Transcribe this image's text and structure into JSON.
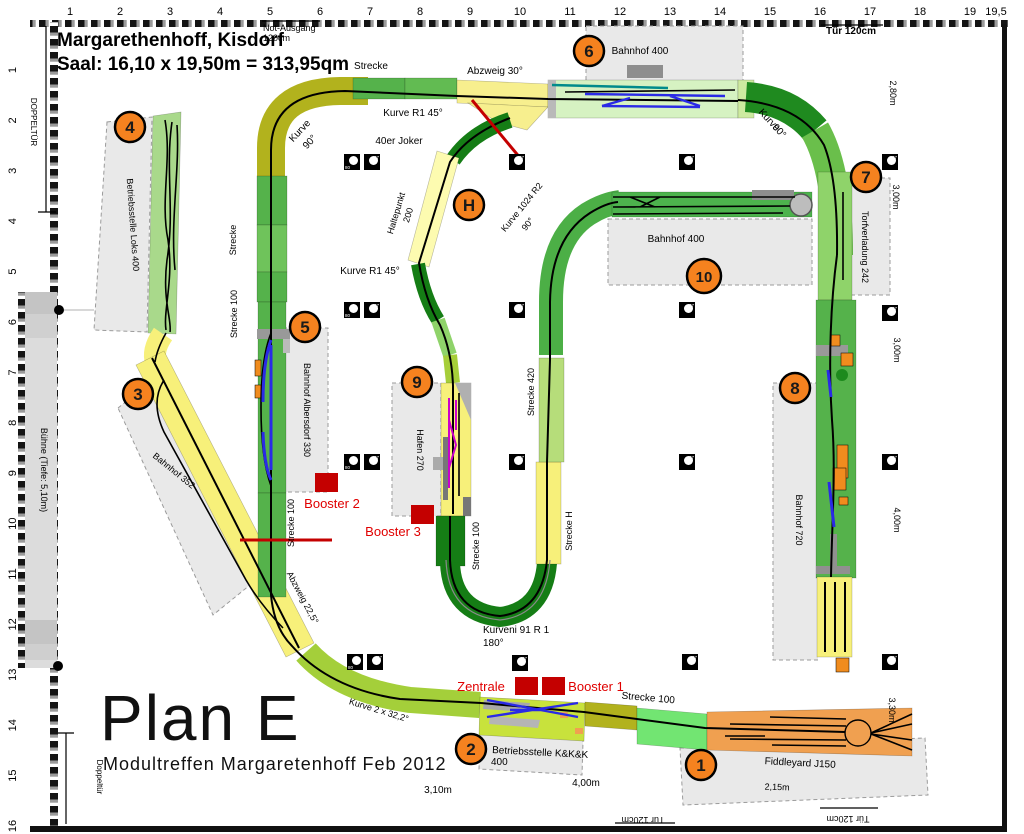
{
  "title": {
    "line1": "Margarethenhoff, Kisdorf",
    "line2": "Saal: 16,10 x 19,50m = 313,95qm"
  },
  "plan": {
    "name": "Plan E",
    "subtitle": "Modultreffen Margaretenhoff Feb 2012"
  },
  "rulers": {
    "top": [
      "1",
      "2",
      "3",
      "4",
      "5",
      "6",
      "7",
      "8",
      "9",
      "10",
      "11",
      "12",
      "13",
      "14",
      "15",
      "16",
      "17",
      "18",
      "19",
      "19,5"
    ],
    "left": [
      "1",
      "2",
      "3",
      "4",
      "5",
      "6",
      "7",
      "8",
      "9",
      "10",
      "11",
      "12",
      "13",
      "14",
      "15",
      "16"
    ]
  },
  "accent_colors": {
    "badge_orange": "#f5821f",
    "booster_red": "#c40000",
    "module_green": "#55b24b",
    "module_yellow": "#f7f07a",
    "module_olive": "#b2b21d",
    "module_orange": "#f0a050"
  },
  "badges": [
    {
      "t": "1",
      "x": 701,
      "y": 765
    },
    {
      "t": "2",
      "x": 471,
      "y": 749
    },
    {
      "t": "3",
      "x": 138,
      "y": 394
    },
    {
      "t": "4",
      "x": 130,
      "y": 127
    },
    {
      "t": "5",
      "x": 305,
      "y": 327
    },
    {
      "t": "6",
      "x": 589,
      "y": 51
    },
    {
      "t": "7",
      "x": 866,
      "y": 177
    },
    {
      "t": "8",
      "x": 795,
      "y": 388
    },
    {
      "t": "9",
      "x": 417,
      "y": 382
    },
    {
      "t": "10",
      "x": 704,
      "y": 276
    },
    {
      "t": "H",
      "x": 469,
      "y": 205
    }
  ],
  "markers": [
    {
      "x": 352,
      "y": 162,
      "n": "80"
    },
    {
      "x": 372,
      "y": 162,
      "n": "37"
    },
    {
      "x": 352,
      "y": 310,
      "n": "80"
    },
    {
      "x": 372,
      "y": 310,
      "n": "37"
    },
    {
      "x": 352,
      "y": 462,
      "n": "80"
    },
    {
      "x": 372,
      "y": 462,
      "n": "37"
    },
    {
      "x": 355,
      "y": 662,
      "n": "80"
    },
    {
      "x": 375,
      "y": 662,
      "n": "37"
    },
    {
      "x": 517,
      "y": 162,
      "n": "37"
    },
    {
      "x": 687,
      "y": 162,
      "n": "37"
    },
    {
      "x": 890,
      "y": 162,
      "n": "37"
    },
    {
      "x": 517,
      "y": 310,
      "n": "37"
    },
    {
      "x": 687,
      "y": 310,
      "n": "37"
    },
    {
      "x": 890,
      "y": 313,
      "n": "37"
    },
    {
      "x": 517,
      "y": 462,
      "n": "37"
    },
    {
      "x": 687,
      "y": 462,
      "n": "37"
    },
    {
      "x": 890,
      "y": 462,
      "n": "37"
    },
    {
      "x": 520,
      "y": 663,
      "n": "37"
    },
    {
      "x": 690,
      "y": 662,
      "n": "37"
    },
    {
      "x": 890,
      "y": 662,
      "n": "37"
    }
  ],
  "labels": [
    {
      "t": "Not-Ausgang",
      "x": 263,
      "y": 31,
      "s": 9,
      "a": "start"
    },
    {
      "t": "120cm",
      "x": 263,
      "y": 41,
      "s": 9,
      "a": "start"
    },
    {
      "t": "Tür 120cm",
      "x": 851,
      "y": 34,
      "s": 10,
      "w": "bold"
    },
    {
      "t": "Strecke",
      "x": 371,
      "y": 69,
      "s": 10
    },
    {
      "t": "Abzweig 30°",
      "x": 495,
      "y": 74,
      "s": 10
    },
    {
      "t": "Bahnhof  400",
      "x": 640,
      "y": 54,
      "s": 10
    },
    {
      "t": "Kurve R1 45°",
      "x": 413,
      "y": 116,
      "s": 10
    },
    {
      "t": "40er Joker",
      "x": 399,
      "y": 144,
      "s": 10
    },
    {
      "t": "Kurve",
      "x": 302,
      "y": 133,
      "s": 10,
      "r": -47
    },
    {
      "t": "90°",
      "x": 312,
      "y": 144,
      "s": 10,
      "r": -47
    },
    {
      "t": "Kurve",
      "x": 767,
      "y": 122,
      "s": 10,
      "r": 47
    },
    {
      "t": "90°",
      "x": 777,
      "y": 133,
      "s": 10,
      "r": 47
    },
    {
      "t": "Haltepunkt",
      "x": 399,
      "y": 214,
      "s": 9,
      "r": -73
    },
    {
      "t": "200",
      "x": 411,
      "y": 216,
      "s": 9,
      "r": -73
    },
    {
      "t": "Kurve 1024 R2",
      "x": 524,
      "y": 209,
      "s": 9,
      "r": -51
    },
    {
      "t": "90°",
      "x": 530,
      "y": 226,
      "s": 9,
      "r": -51
    },
    {
      "t": "Kurve R1 45°",
      "x": 370,
      "y": 274,
      "s": 10
    },
    {
      "t": "Strecke",
      "x": 236,
      "y": 240,
      "s": 9,
      "r": -90
    },
    {
      "t": "Strecke 100",
      "x": 237,
      "y": 314,
      "s": 9,
      "r": -90
    },
    {
      "t": "2,80m",
      "x": 890,
      "y": 93,
      "s": 9,
      "r": 90
    },
    {
      "t": "3,00m",
      "x": 893,
      "y": 197,
      "s": 9,
      "r": 90
    },
    {
      "t": "3,00m",
      "x": 894,
      "y": 350,
      "s": 9,
      "r": 90
    },
    {
      "t": "4,00m",
      "x": 894,
      "y": 520,
      "s": 9,
      "r": 90
    },
    {
      "t": "3,30m",
      "x": 889,
      "y": 710,
      "s": 9,
      "r": 90
    },
    {
      "t": "Torfverladung 242",
      "x": 862,
      "y": 247,
      "s": 9,
      "r": 90
    },
    {
      "t": "Bahnhof  400",
      "x": 676,
      "y": 242,
      "s": 10
    },
    {
      "t": "Bahnhof 720",
      "x": 796,
      "y": 520,
      "s": 9,
      "r": 90
    },
    {
      "t": "Betriebsstelle Loks 400",
      "x": 130,
      "y": 225,
      "s": 9,
      "r": 86
    },
    {
      "t": "Bahnhof Albersdorf 330",
      "x": 304,
      "y": 410,
      "s": 9,
      "r": 90
    },
    {
      "t": "Bahnhof 352",
      "x": 172,
      "y": 473,
      "s": 9,
      "r": 39
    },
    {
      "t": "Strecke 100",
      "x": 294,
      "y": 523,
      "s": 9,
      "r": -90
    },
    {
      "t": "Booster 2",
      "x": 332,
      "y": 508,
      "s": 13,
      "c": "#e00000"
    },
    {
      "t": "Hafen 270",
      "x": 417,
      "y": 450,
      "s": 9,
      "r": 90
    },
    {
      "t": "Booster 3",
      "x": 393,
      "y": 536,
      "s": 13,
      "c": "#e00000"
    },
    {
      "t": "Strecke 100",
      "x": 479,
      "y": 546,
      "s": 9,
      "r": -90
    },
    {
      "t": "Strecke 420",
      "x": 534,
      "y": 392,
      "s": 9,
      "r": -90
    },
    {
      "t": "Strecke H",
      "x": 572,
      "y": 531,
      "s": 9,
      "r": -90
    },
    {
      "t": "Abzweig 22,5°",
      "x": 300,
      "y": 599,
      "s": 9,
      "r": 62
    },
    {
      "t": "Kurve 2 x 32,2°",
      "x": 378,
      "y": 713,
      "s": 9,
      "r": 17
    },
    {
      "t": "Kurveni 91 R 1",
      "x": 483,
      "y": 633,
      "s": 10,
      "a": "start"
    },
    {
      "t": "180°",
      "x": 483,
      "y": 646,
      "s": 10,
      "a": "start"
    },
    {
      "t": "Zentrale",
      "x": 481,
      "y": 691,
      "s": 13,
      "c": "#e00000"
    },
    {
      "t": "Booster 1",
      "x": 596,
      "y": 691,
      "s": 13,
      "c": "#e00000"
    },
    {
      "t": "Strecke 100",
      "x": 648,
      "y": 701,
      "s": 10,
      "r": 5
    },
    {
      "t": "Betriebsstelle K&K&K",
      "x": 492,
      "y": 753,
      "s": 10,
      "a": "start",
      "r": 3
    },
    {
      "t": "400",
      "x": 491,
      "y": 765,
      "s": 10,
      "a": "start"
    },
    {
      "t": "Fiddleyard J150",
      "x": 800,
      "y": 766,
      "s": 10,
      "r": 3
    },
    {
      "t": "2,15m",
      "x": 777,
      "y": 790,
      "s": 9,
      "r": 2
    },
    {
      "t": "3,10m",
      "x": 438,
      "y": 793,
      "s": 10
    },
    {
      "t": "4,00m",
      "x": 586,
      "y": 786,
      "s": 10
    },
    {
      "t": "Tür 120cm",
      "x": 643,
      "y": 817,
      "s": 9,
      "r": 180
    },
    {
      "t": "Tür 120cm",
      "x": 848,
      "y": 816,
      "s": 9,
      "r": 180
    },
    {
      "t": "DOPPELTÜR",
      "x": 31,
      "y": 122,
      "s": 8,
      "r": 90
    },
    {
      "t": "Doppeltür",
      "x": 97,
      "y": 777,
      "s": 8,
      "r": 90
    },
    {
      "t": "Bühne (Tiefe: 5,10m)",
      "x": 41,
      "y": 470,
      "s": 9,
      "r": 90
    }
  ]
}
